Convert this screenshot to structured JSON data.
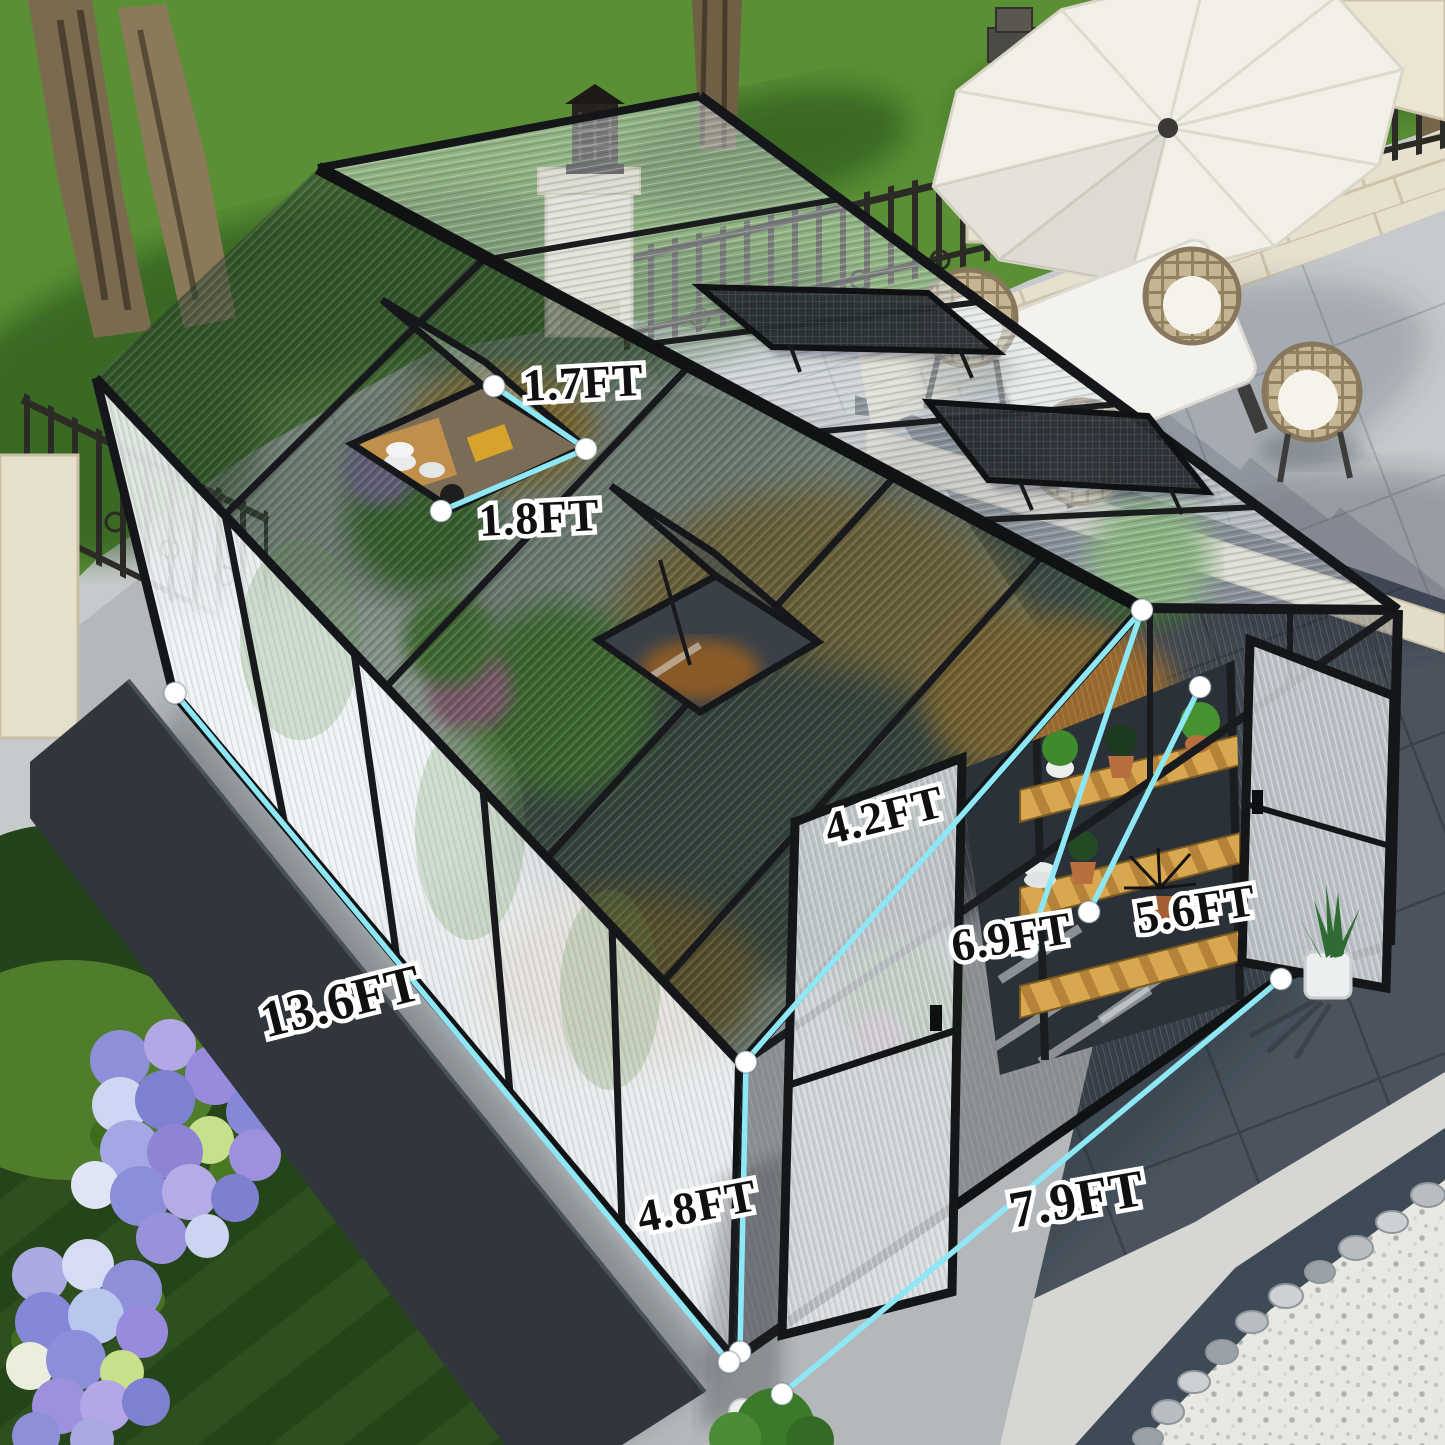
{
  "scene": {
    "type": "product dimension photo",
    "subject": "walk-in polycarbonate greenhouse with black aluminum frame in a backyard",
    "setting": [
      "green lawn with trees",
      "wrought iron fence",
      "stone pillars with lantern",
      "paver patio",
      "white patio umbrella",
      "white square dining table",
      "four wicker chairs with white cushions",
      "two open roof vent windows per slope",
      "open hinged doors",
      "wooden shelves with potted plants inside",
      "hydrangea flower bed",
      "dark concrete curb",
      "white pebble border with river stones",
      "potted succulent"
    ]
  },
  "dimensions": {
    "unit": "FT",
    "labels": [
      {
        "id": "roof-vent-width",
        "text": "1.7FT"
      },
      {
        "id": "roof-vent-length",
        "text": "1.8FT"
      },
      {
        "id": "roof-slope",
        "text": "4.2FT"
      },
      {
        "id": "eave-height",
        "text": "5.6FT"
      },
      {
        "id": "ridge-height",
        "text": "6.9FT"
      },
      {
        "id": "overall-length",
        "text": "13.6FT"
      },
      {
        "id": "side-wall-height",
        "text": "4.8FT"
      },
      {
        "id": "overall-width",
        "text": "7.9FT"
      }
    ]
  },
  "colors": {
    "dimension_line": "#8ee7f4",
    "dimension_dot": "#ffffff",
    "label_fill": "#101010",
    "label_outline": "#ffffff",
    "frame": "#17191c",
    "lawn": "#5a8f35",
    "patio_tile": "#c6cacc",
    "slate_tile": "#4b545e",
    "limestone": "#e7e0cd",
    "umbrella": "#f2efe7"
  }
}
